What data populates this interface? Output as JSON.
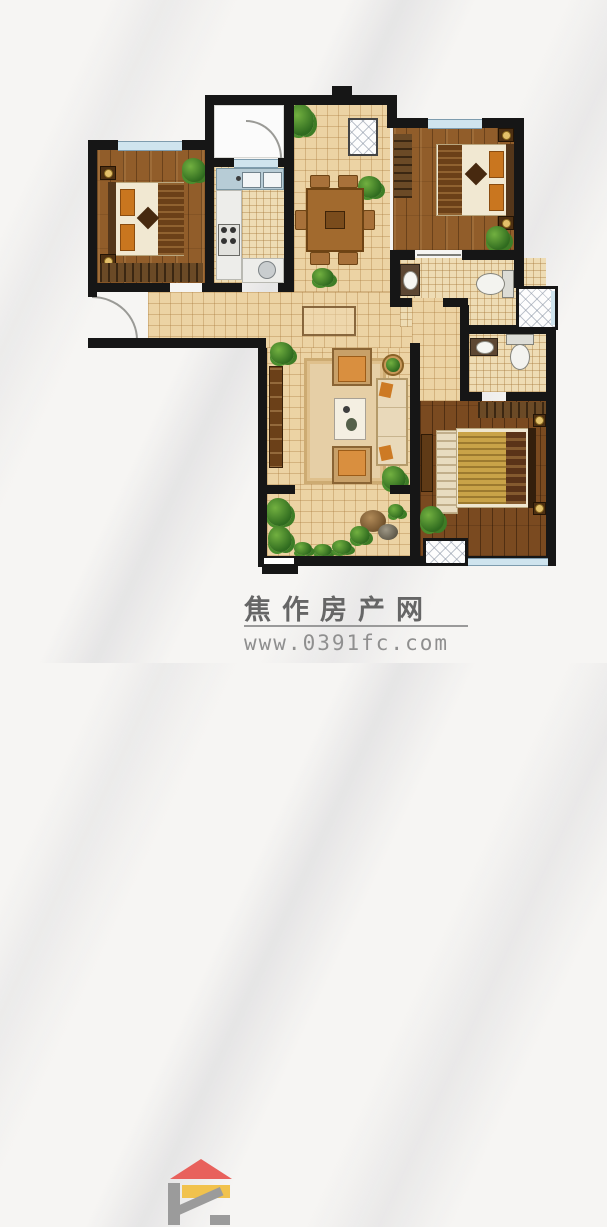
{
  "watermark": {
    "site_name": "焦作房产网",
    "url": "www.0391fc.com"
  },
  "colors": {
    "wall": "#161616",
    "tile": "#ecd3a4",
    "tile_fine": "#eedcb4",
    "wood": "#915d2a",
    "wood_dark": "#7a4a20",
    "window": "#cfe4ee",
    "white_room": "#fbfbfb",
    "logo_roof": "#e8615c",
    "logo_body": "#9b9b9b",
    "logo_bar": "#f1c24d",
    "title_text": "#666666",
    "url_text": "#8f8f8f"
  }
}
